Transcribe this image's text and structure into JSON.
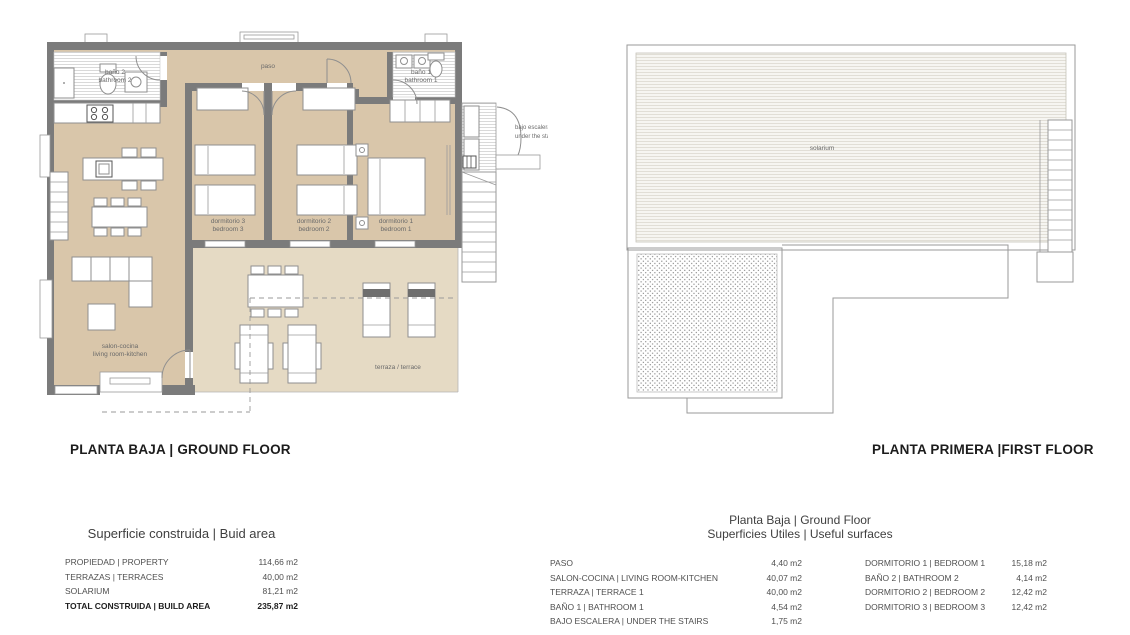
{
  "ground_floor": {
    "title": "PLANTA BAJA | GROUND FLOOR",
    "labels": {
      "bano2": [
        "baño 2",
        "bathroom 2"
      ],
      "paso": "paso",
      "bano1": [
        "baño 1",
        "bathroom 1"
      ],
      "dormitorio3": [
        "dormitorio 3",
        "bedroom 3"
      ],
      "dormitorio2": [
        "dormitorio 2",
        "bedroom 2"
      ],
      "dormitorio1": [
        "dormitorio 1",
        "bedroom 1"
      ],
      "salon": [
        "salon-cocina",
        "living room-kitchen"
      ],
      "terraza": "terraza / terrace",
      "bajo_escalera": [
        "bajo escalera",
        "under the stairs"
      ]
    }
  },
  "first_floor": {
    "title": "PLANTA PRIMERA |FIRST FLOOR",
    "labels": {
      "solarium": "solarium"
    }
  },
  "build_area_table": {
    "title": "Superficie construida | Buid area",
    "rows": [
      {
        "label": "PROPIEDAD | PROPERTY",
        "value": "114,66 m2"
      },
      {
        "label": "TERRAZAS | TERRACES",
        "value": "40,00 m2"
      },
      {
        "label": "SOLARIUM",
        "value": "81,21 m2"
      },
      {
        "label": "TOTAL CONSTRUIDA | BUILD AREA",
        "value": "235,87 m2"
      }
    ]
  },
  "useful_surfaces_table": {
    "title_line1": "Planta Baja | Ground Floor",
    "title_line2": "Superficies Utiles | Useful surfaces",
    "left_rows": [
      {
        "label": "PASO",
        "value": "4,40 m2"
      },
      {
        "label": "SALON-COCINA | LIVING ROOM-KITCHEN",
        "value": "40,07 m2"
      },
      {
        "label": "TERRAZA | TERRACE 1",
        "value": "40,00 m2"
      },
      {
        "label": "BAÑO 1 | BATHROOM 1",
        "value": "4,54 m2"
      },
      {
        "label": "BAJO ESCALERA | UNDER THE STAIRS",
        "value": "1,75 m2"
      }
    ],
    "right_rows": [
      {
        "label": "DORMITORIO 1 | BEDROOM 1",
        "value": "15,18 m2"
      },
      {
        "label": "BAÑO 2 | BATHROOM 2",
        "value": "4,14 m2"
      },
      {
        "label": "DORMITORIO 2 | BEDROOM 2",
        "value": "12,42 m2"
      },
      {
        "label": "DORMITORIO 3 | BEDROOM 3",
        "value": "12,42 m2"
      }
    ]
  },
  "colors": {
    "wall": "#7b7b7b",
    "interior_floor": "#d9c6aa",
    "terrace_floor": "#e5dac4",
    "title_text": "#1c1c1c",
    "label_text": "#6a6a6a"
  }
}
